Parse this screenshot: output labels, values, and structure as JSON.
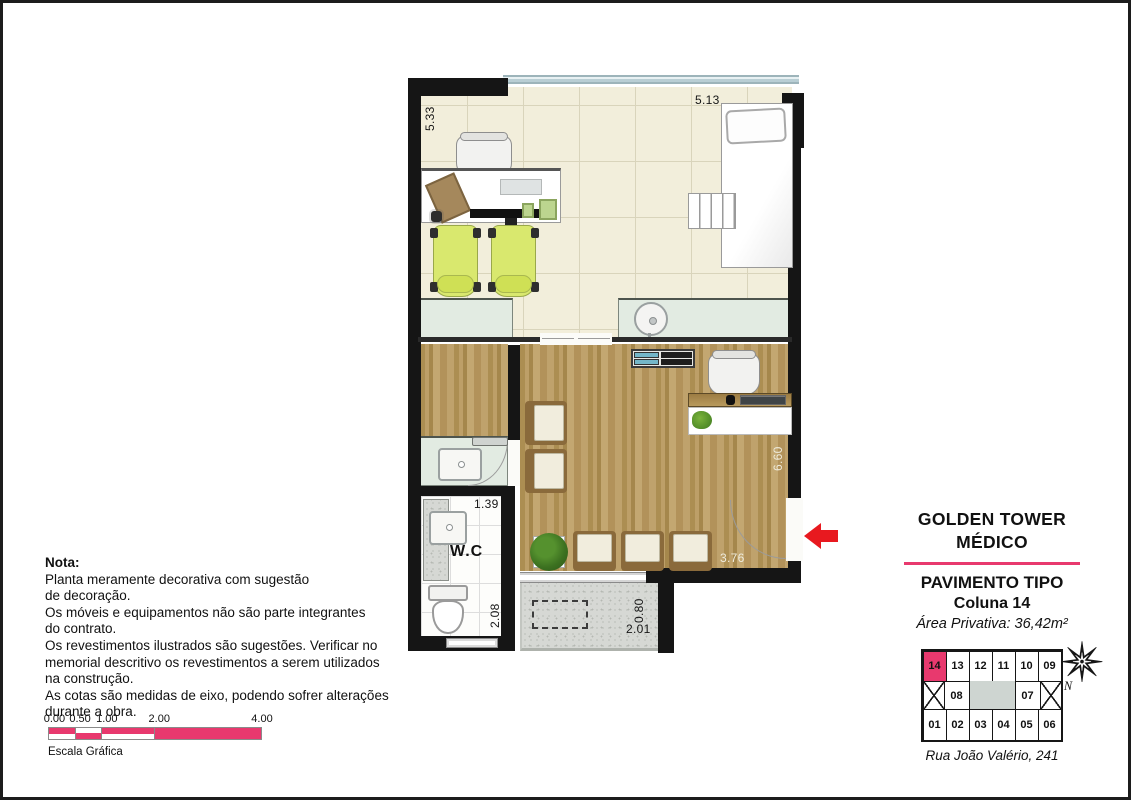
{
  "colors": {
    "accent_pink": "#e8396e",
    "entry_arrow_red": "#e8191f",
    "wood": "#b4975d",
    "tile_cream": "#f2eedb",
    "counter_mint": "#e2ebe2"
  },
  "plan": {
    "wc_label": "W.C",
    "dims": {
      "top_width": "5.13",
      "left_height": "5.33",
      "right_height": "6.60",
      "waiting_width": "3.76",
      "wc_width": "1.39",
      "wc_depth": "2.08",
      "terrace_depth": "0.80",
      "terrace_width": "2.01"
    }
  },
  "note": {
    "title": "Nota:",
    "lines": [
      "Planta meramente decorativa com sugestão",
      "de decoração.",
      "Os móveis e equipamentos não são parte integrantes",
      "do contrato.",
      "Os revestimentos ilustrados são sugestões. Verificar no",
      "memorial descritivo os revestimentos a serem utilizados",
      "na construção.",
      "As cotas são medidas de eixo, podendo sofrer alterações",
      "durante a obra."
    ]
  },
  "scale_bar": {
    "labels": [
      "0.00",
      "0.50",
      "1.00",
      "2.00",
      "4.00"
    ],
    "caption": "Escala Gráfica"
  },
  "title_block": {
    "building_line1": "GOLDEN TOWER",
    "building_line2": "MÉDICO",
    "floor_type": "PAVIMENTO TIPO",
    "column": "Coluna 14",
    "private_area": "Área Privativa: 36,42m²"
  },
  "keyplan": {
    "top_row": [
      "14",
      "13",
      "12",
      "11",
      "10",
      "09"
    ],
    "mid_row": [
      "08",
      "07"
    ],
    "bottom_row": [
      "01",
      "02",
      "03",
      "04",
      "05",
      "06"
    ],
    "highlighted_unit": "14",
    "compass_label": "N",
    "address": "Rua João Valério, 241"
  }
}
